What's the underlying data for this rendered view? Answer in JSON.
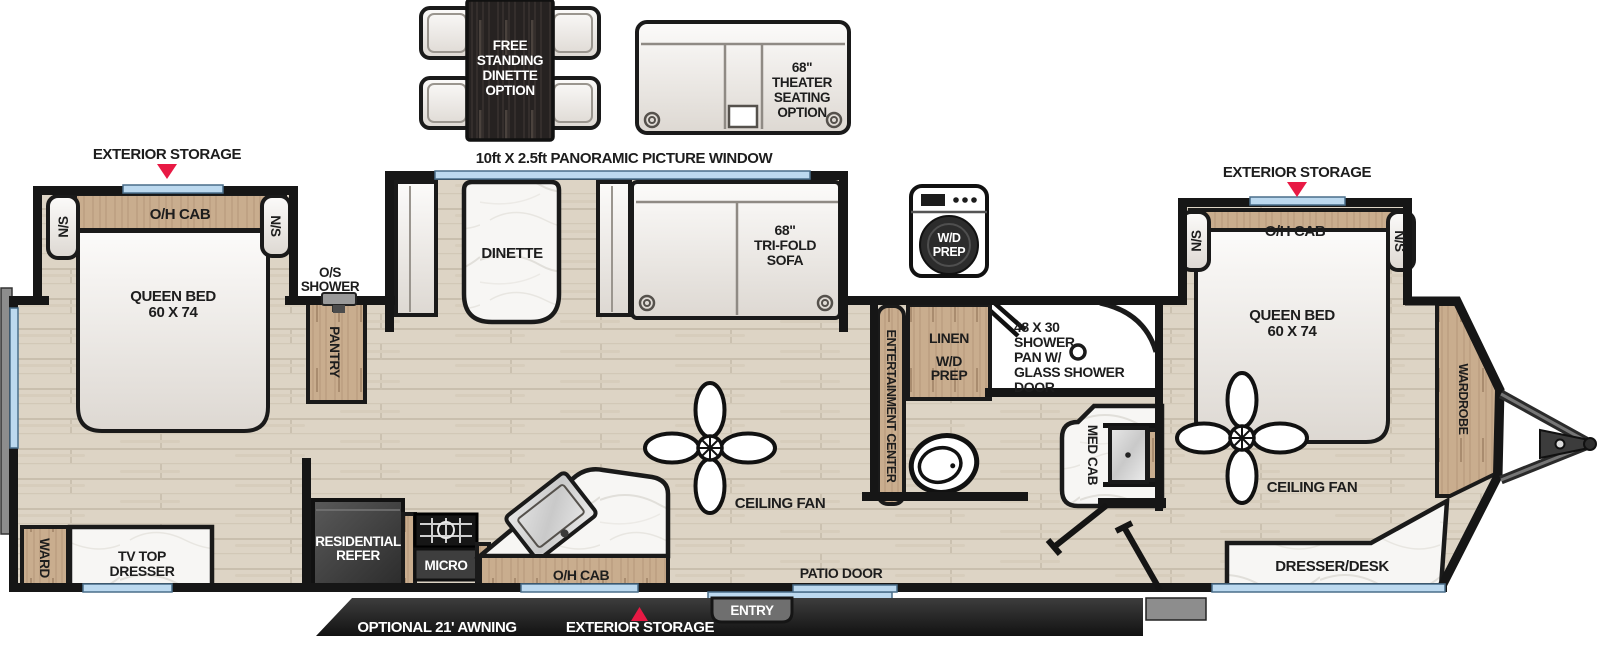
{
  "colors": {
    "accent_red": "#e81944",
    "window_blue": "#bcd9ef",
    "cabinet_wood": "#c9ad8e",
    "wall_black": "#161616",
    "floor_tan": "#ddd4c5"
  },
  "options": {
    "dinette": {
      "lines": [
        "FREE",
        "STANDING",
        "DINETTE",
        "OPTION"
      ]
    },
    "theater": {
      "lines": [
        "68\"",
        "THEATER",
        "SEATING",
        "OPTION"
      ]
    },
    "wd_prep": {
      "lines": [
        "W/D",
        "PREP"
      ]
    }
  },
  "exterior": {
    "storage_left": "EXTERIOR STORAGE",
    "storage_right": "EXTERIOR STORAGE",
    "storage_bottom": "EXTERIOR STORAGE",
    "awning": "OPTIONAL 21' AWNING",
    "entry": "ENTRY",
    "patio_door": "PATIO DOOR",
    "window_label": "10ft X 2.5ft PANORAMIC PICTURE WINDOW"
  },
  "rear_bedroom": {
    "oh_cab": "O/H CAB",
    "ns_left": "N/S",
    "ns_right": "N/S",
    "bed_lines": [
      "QUEEN BED",
      "60 X 74"
    ],
    "ward": "WARD",
    "tv_dresser_lines": [
      "TV TOP",
      "DRESSER"
    ]
  },
  "living": {
    "os_shower_lines": [
      "O/S",
      "SHOWER"
    ],
    "pantry": "PANTRY",
    "dinette": "DINETTE",
    "sofa_lines": [
      "68\"",
      "TRI-FOLD",
      "SOFA"
    ],
    "ceiling_fan": "CEILING FAN",
    "entertainment": "ENTERTAINMENT CENTER"
  },
  "kitchen": {
    "refer_lines": [
      "RESIDENTIAL",
      "REFER"
    ],
    "micro": "MICRO",
    "oh_cab": "O/H CAB"
  },
  "bathroom": {
    "linen": "LINEN",
    "wd_lines": [
      "W/D",
      "PREP"
    ],
    "shower_lines": [
      "48 X 30",
      "SHOWER",
      "PAN W/",
      "GLASS SHOWER",
      "DOOR"
    ],
    "med_cab": "MED CAB"
  },
  "front_bedroom": {
    "oh_cab": "O/H CAB",
    "ns_left": "N/S",
    "ns_right": "N/S",
    "bed_lines": [
      "QUEEN BED",
      "60 X 74"
    ],
    "wardrobe": "WARDROBE",
    "ceiling_fan": "CEILING FAN",
    "dresser_desk": "DRESSER/DESK"
  }
}
